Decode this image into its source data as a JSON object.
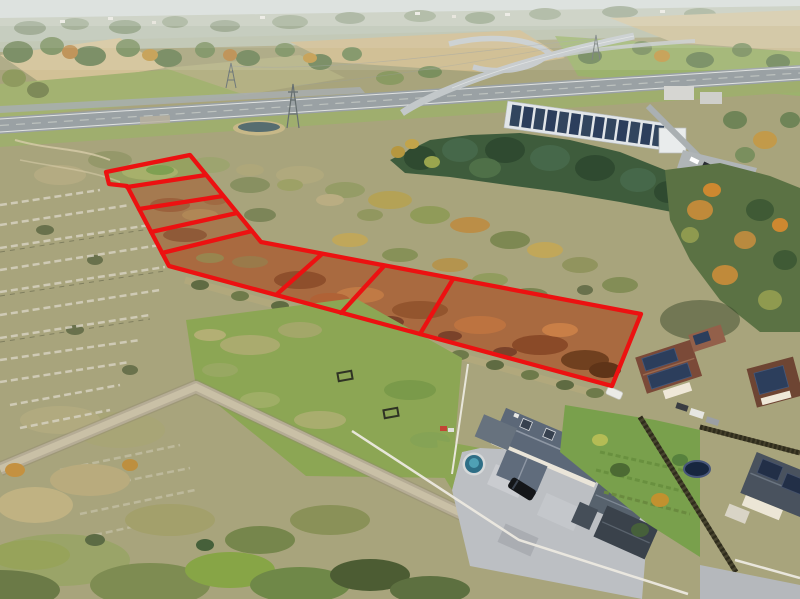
{
  "image": {
    "kind": "aerial-drone-photo",
    "subject": "building-plots-for-sale-marked-with-red-boundary-overlay",
    "plot_count": 8
  },
  "palette": {
    "boundary_red": "#ec1111",
    "sky_haze": "#cfd6d2",
    "village_band": "#b7c0ad",
    "field_tan": "#ccb98b",
    "meadow_green": "#a3b271",
    "highway_gray": "#9aa1a4",
    "embankment_green": "#9fae6e",
    "scrub_olive": "#a8a47c",
    "conifer_green": "#3e5c3c",
    "forest_mixed": "#5b7244",
    "parcel_rust": "#a96a40",
    "parcel_strip_rust": "#a57a50",
    "parcel_grass": "#96a161",
    "lawn_green": "#8ca654",
    "garden_green": "#79a04c",
    "road_gravel": "#b5ac95",
    "paved_yard": "#bcbfc3",
    "roof_gray": "#5c6878",
    "roof_brown": "#7b4a38",
    "roof_dark_gray": "#49525e",
    "solar_panel_blue": "#2c3e5c",
    "pond_water": "#566d70",
    "house_wall": "#eae3d1",
    "white_fence": "#ece9e0",
    "warehouse_roof": "#e2e6e9"
  },
  "plots": {
    "outline": [
      [
        106,
        172
      ],
      [
        190,
        155
      ],
      [
        261,
        242
      ],
      [
        641,
        314
      ],
      [
        612,
        386
      ],
      [
        169,
        266
      ],
      [
        127,
        186
      ],
      [
        109,
        184
      ]
    ],
    "dividers": [
      [
        [
          127,
          187
        ],
        [
          206,
          175
        ]
      ],
      [
        [
          139,
          209
        ],
        [
          223,
          196
        ]
      ],
      [
        [
          151,
          232
        ],
        [
          237,
          213
        ]
      ],
      [
        [
          162,
          253
        ],
        [
          252,
          231
        ]
      ],
      [
        [
          322,
          254
        ],
        [
          276,
          295
        ]
      ],
      [
        [
          384,
          266
        ],
        [
          341,
          313
        ]
      ],
      [
        [
          453,
          279
        ],
        [
          420,
          334
        ]
      ]
    ],
    "stroke_width": 4.3
  }
}
